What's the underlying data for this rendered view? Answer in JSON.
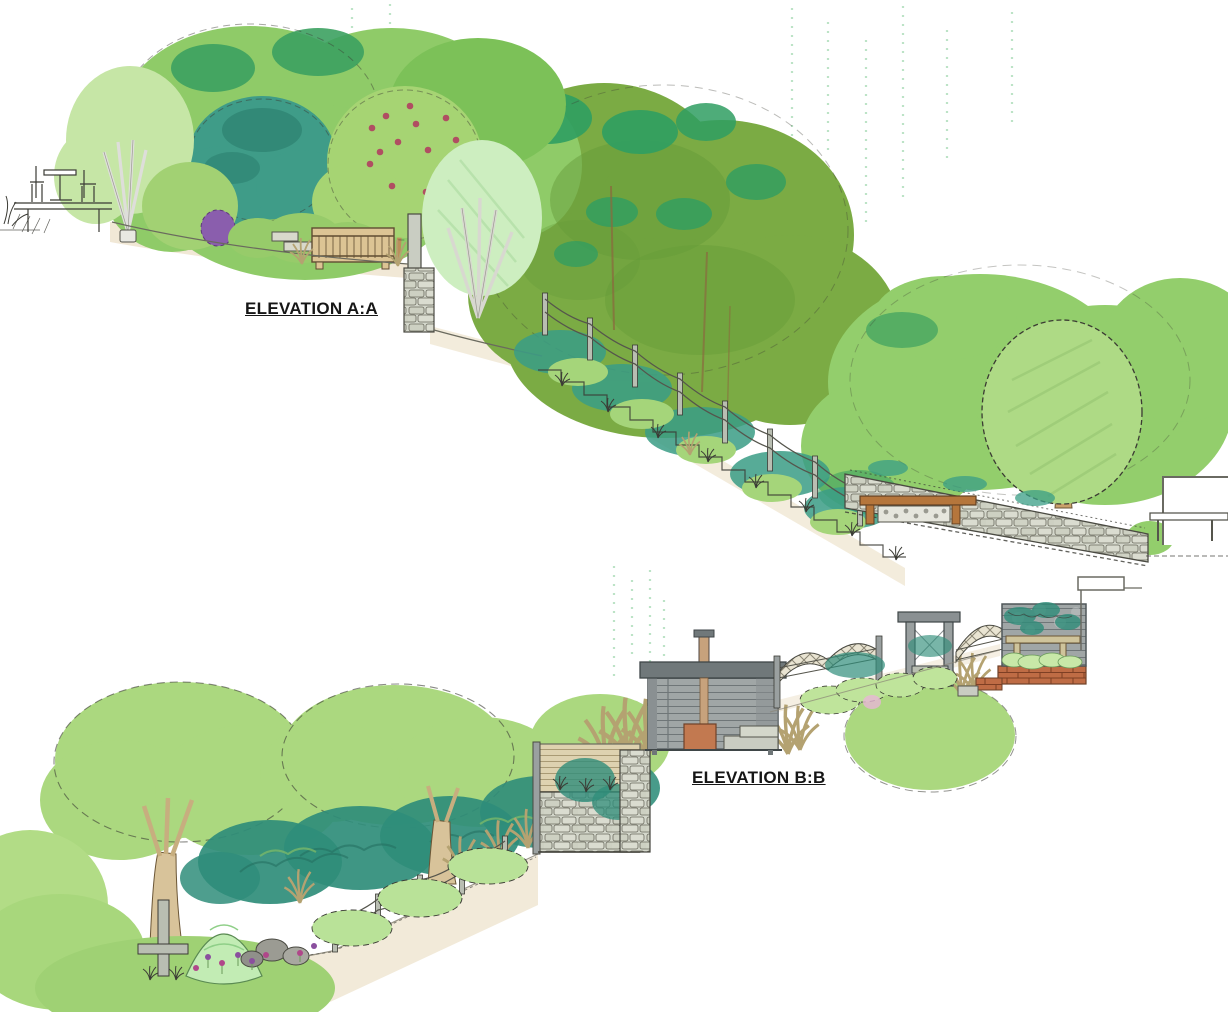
{
  "document": {
    "kind": "hand-drawn garden elevation sketches",
    "background": "#ffffff"
  },
  "labels": {
    "elevation_a": "ELEVATION A:A",
    "elevation_b": "ELEVATION B:B"
  },
  "palette": {
    "ink": "#3b3b35",
    "light_green": "#abd87f",
    "mid_green": "#8fcb68",
    "dark_green": "#3ca160",
    "olive_green": "#7bab44",
    "teal_green": "#3f9c88",
    "pale_mint": "#c2ecb4",
    "trunk_tan": "#c7a878",
    "bench_wood": "#d9bf8e",
    "stone_grey": "#d4d7cb",
    "shed_grey": "#a0a6a6",
    "copper_stove": "#c27950",
    "brick_red": "#bf6c45",
    "purple": "#8a5ead",
    "berry_red": "#b04e62",
    "ground_tan": "#e9dcc0"
  },
  "elevation_a": {
    "elements": [
      "patio-table-and-chairs",
      "silver-birch-tree",
      "round-bush",
      "evergreen-teal-tree",
      "fruit-tree-with-red-berries",
      "purple-shrub",
      "garden-bench",
      "garden-steps",
      "ornamental-pale-tree",
      "retaining-wall-steps",
      "dense-tree-canopies",
      "post-and-wire-fence",
      "slope-steps",
      "grass-tufts",
      "dry-stone-wall",
      "stone-filled-bench",
      "round-specimen-tree",
      "neighbour-building",
      "bench-by-building"
    ]
  },
  "elevation_b": {
    "elements": [
      "mature-trees",
      "low-hedges",
      "teal-understorey",
      "ornamental-grasses",
      "conical-mint-shrub",
      "boulders",
      "flower-planting",
      "timber-cross-post",
      "post-and-wire-fence",
      "stone-retaining-wall",
      "timber-slat-fence",
      "garden-studio-shed",
      "flue-chimney",
      "log-burner-stove",
      "stone-bench-blocks",
      "trellis-fence-panels",
      "pergola",
      "brick-retaining-wall",
      "slatted-screen-wall-with-climbers",
      "timber-bench",
      "house-eaves"
    ]
  }
}
